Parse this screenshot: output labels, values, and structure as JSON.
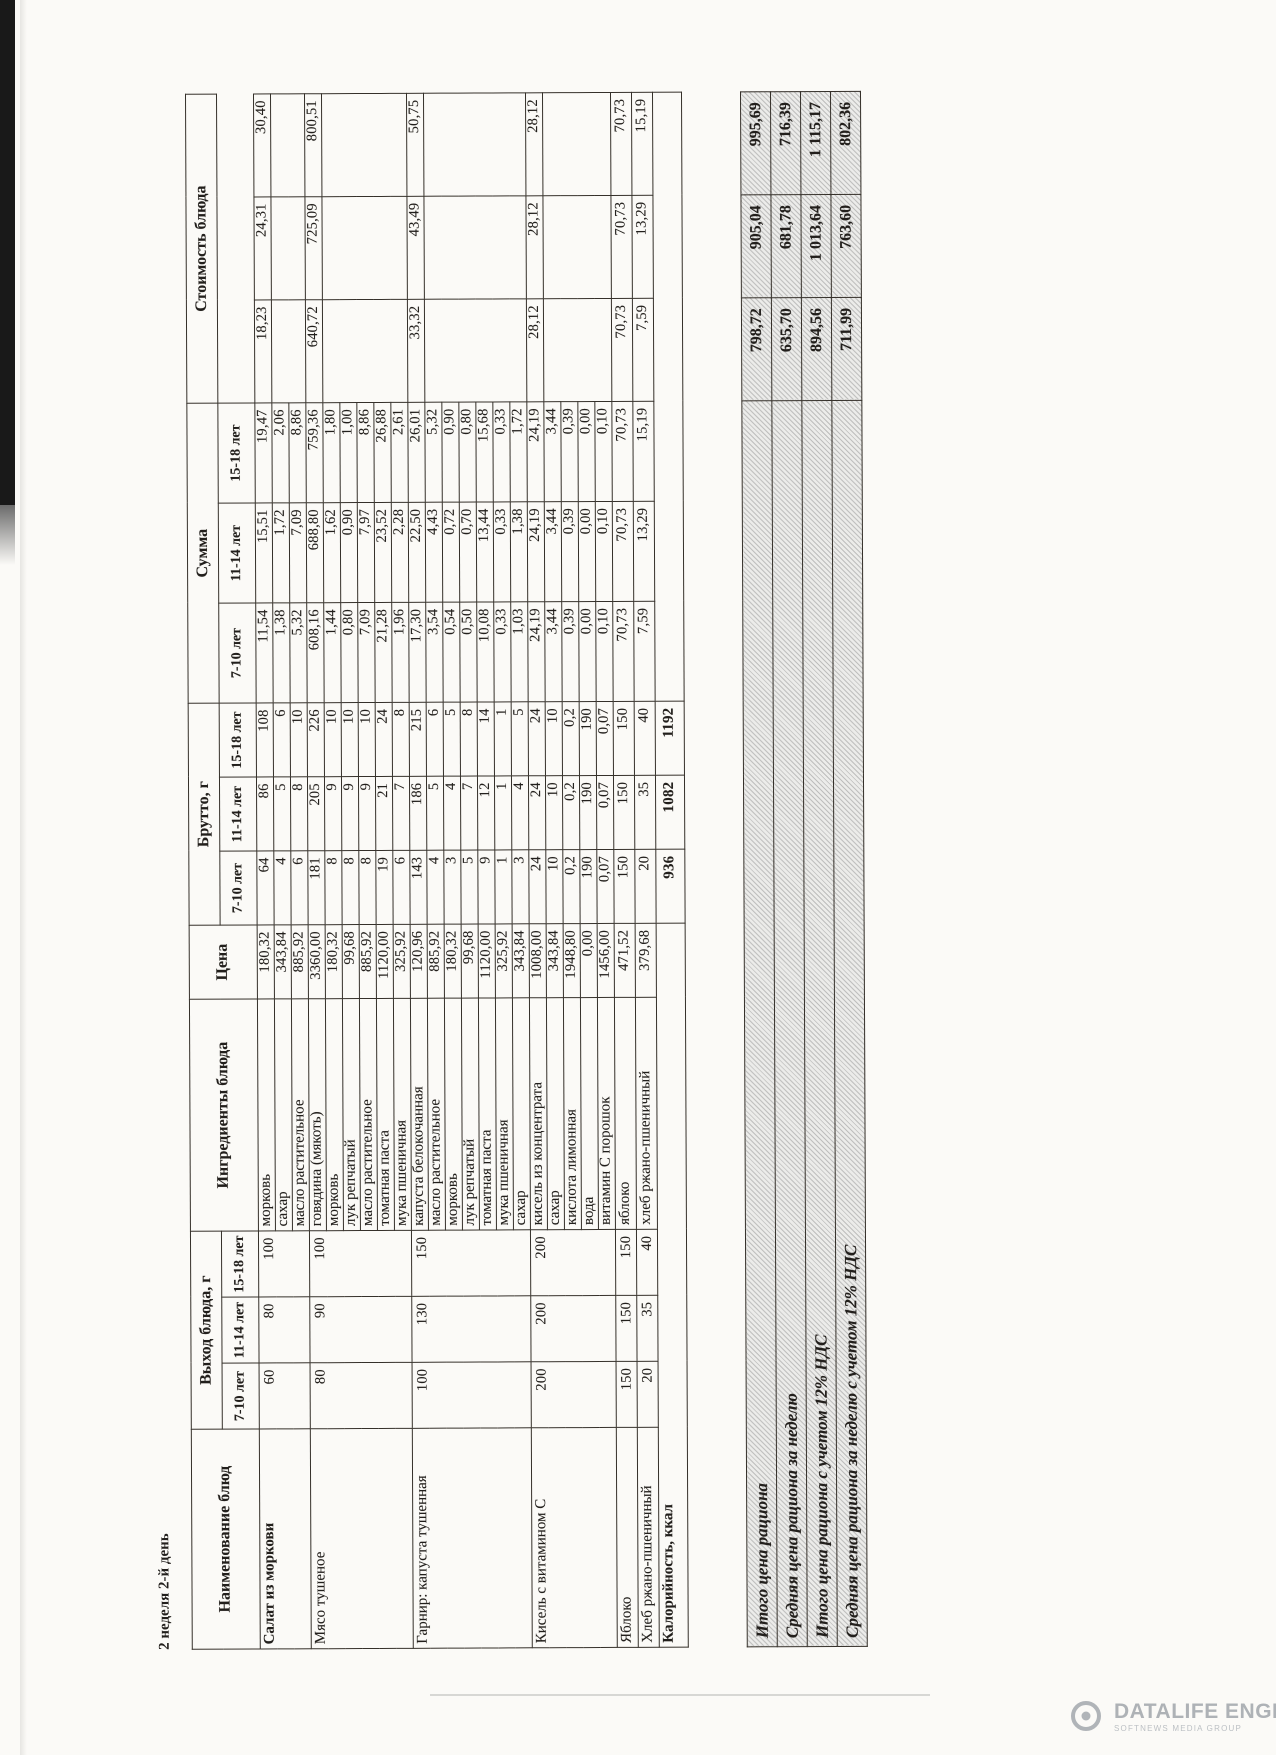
{
  "page": {
    "side_title": "2 неделя 2-й день"
  },
  "watermark": {
    "name": "DATALIFE ENGINE",
    "tagline": "SOFTNEWS MEDIA GROUP"
  },
  "menu_table": {
    "headers": {
      "dish": "Наименование блюд",
      "yield_group": "Выход блюда, г",
      "ingredients": "Ингредиенты блюда",
      "price": "Цена",
      "brutto_group": "Брутто, г",
      "sum_group": "Сумма",
      "cost_group": "Стоимость блюда",
      "ages": [
        "7-10 лет",
        "11-14 лет",
        "15-18 лет"
      ]
    },
    "dishes": [
      {
        "name": "Салат из моркови",
        "yield": [
          "60",
          "80",
          "100"
        ],
        "cost": [
          "18,23",
          "24,31",
          "30,40"
        ],
        "ingredients": [
          {
            "name": "морковь",
            "price": "180,32",
            "brutto": [
              "64",
              "86",
              "108"
            ],
            "sum": [
              "11,54",
              "15,51",
              "19,47"
            ]
          },
          {
            "name": "сахар",
            "price": "343,84",
            "brutto": [
              "4",
              "5",
              "6"
            ],
            "sum": [
              "1,38",
              "1,72",
              "2,06"
            ]
          },
          {
            "name": "масло растительное",
            "price": "885,92",
            "brutto": [
              "6",
              "8",
              "10"
            ],
            "sum": [
              "5,32",
              "7,09",
              "8,86"
            ]
          }
        ]
      },
      {
        "name": "Мясо тушеное",
        "yield": [
          "80",
          "90",
          "100"
        ],
        "cost": [
          "640,72",
          "725,09",
          "800,51"
        ],
        "ingredients": [
          {
            "name": "говядина (мякоть)",
            "price": "3360,00",
            "brutto": [
              "181",
              "205",
              "226"
            ],
            "sum": [
              "608,16",
              "688,80",
              "759,36"
            ]
          },
          {
            "name": "морковь",
            "price": "180,32",
            "brutto": [
              "8",
              "9",
              "10"
            ],
            "sum": [
              "1,44",
              "1,62",
              "1,80"
            ]
          },
          {
            "name": "лук репчатый",
            "price": "99,68",
            "brutto": [
              "8",
              "9",
              "10"
            ],
            "sum": [
              "0,80",
              "0,90",
              "1,00"
            ]
          },
          {
            "name": "масло растительное",
            "price": "885,92",
            "brutto": [
              "8",
              "9",
              "10"
            ],
            "sum": [
              "7,09",
              "7,97",
              "8,86"
            ]
          },
          {
            "name": "томатная паста",
            "price": "1120,00",
            "brutto": [
              "19",
              "21",
              "24"
            ],
            "sum": [
              "21,28",
              "23,52",
              "26,88"
            ]
          },
          {
            "name": "мука пшеничная",
            "price": "325,92",
            "brutto": [
              "6",
              "7",
              "8"
            ],
            "sum": [
              "1,96",
              "2,28",
              "2,61"
            ]
          }
        ]
      },
      {
        "name": "Гарнир: капуста тушенная",
        "yield": [
          "100",
          "130",
          "150"
        ],
        "cost": [
          "33,32",
          "43,49",
          "50,75"
        ],
        "ingredients": [
          {
            "name": "капуста белокочанная",
            "price": "120,96",
            "brutto": [
              "143",
              "186",
              "215"
            ],
            "sum": [
              "17,30",
              "22,50",
              "26,01"
            ]
          },
          {
            "name": "масло растительное",
            "price": "885,92",
            "brutto": [
              "4",
              "5",
              "6"
            ],
            "sum": [
              "3,54",
              "4,43",
              "5,32"
            ]
          },
          {
            "name": "морковь",
            "price": "180,32",
            "brutto": [
              "3",
              "4",
              "5"
            ],
            "sum": [
              "0,54",
              "0,72",
              "0,90"
            ]
          },
          {
            "name": "лук репчатый",
            "price": "99,68",
            "brutto": [
              "5",
              "7",
              "8"
            ],
            "sum": [
              "0,50",
              "0,70",
              "0,80"
            ]
          },
          {
            "name": "томатная паста",
            "price": "1120,00",
            "brutto": [
              "9",
              "12",
              "14"
            ],
            "sum": [
              "10,08",
              "13,44",
              "15,68"
            ]
          },
          {
            "name": "мука пшеничная",
            "price": "325,92",
            "brutto": [
              "1",
              "1",
              "1"
            ],
            "sum": [
              "0,33",
              "0,33",
              "0,33"
            ]
          },
          {
            "name": "сахар",
            "price": "343,84",
            "brutto": [
              "3",
              "4",
              "5"
            ],
            "sum": [
              "1,03",
              "1,38",
              "1,72"
            ]
          }
        ]
      },
      {
        "name": "Кисель с витамином С",
        "yield": [
          "200",
          "200",
          "200"
        ],
        "cost": [
          "28,12",
          "28,12",
          "28,12"
        ],
        "ingredients": [
          {
            "name": "кисель из концентрата",
            "price": "1008,00",
            "brutto": [
              "24",
              "24",
              "24"
            ],
            "sum": [
              "24,19",
              "24,19",
              "24,19"
            ]
          },
          {
            "name": "сахар",
            "price": "343,84",
            "brutto": [
              "10",
              "10",
              "10"
            ],
            "sum": [
              "3,44",
              "3,44",
              "3,44"
            ]
          },
          {
            "name": "кислота лимонная",
            "price": "1948,80",
            "brutto": [
              "0,2",
              "0,2",
              "0,2"
            ],
            "sum": [
              "0,39",
              "0,39",
              "0,39"
            ]
          },
          {
            "name": "вода",
            "price": "0,00",
            "brutto": [
              "190",
              "190",
              "190"
            ],
            "sum": [
              "0,00",
              "0,00",
              "0,00"
            ]
          },
          {
            "name": "витамин С порошок",
            "price": "1456,00",
            "brutto": [
              "0,07",
              "0,07",
              "0,07"
            ],
            "sum": [
              "0,10",
              "0,10",
              "0,10"
            ]
          }
        ]
      },
      {
        "name": "Яблоко",
        "yield": [
          "150",
          "150",
          "150"
        ],
        "cost": [
          "70,73",
          "70,73",
          "70,73"
        ],
        "ingredients": [
          {
            "name": "яблоко",
            "price": "471,52",
            "brutto": [
              "150",
              "150",
              "150"
            ],
            "sum": [
              "70,73",
              "70,73",
              "70,73"
            ]
          }
        ]
      },
      {
        "name": "Хлеб ржано-пшеничный",
        "yield": [
          "20",
          "35",
          "40"
        ],
        "cost": [
          "7,59",
          "13,29",
          "15,19"
        ],
        "ingredients": [
          {
            "name": "хлеб ржано-пшеничный",
            "price": "379,68",
            "brutto": [
              "20",
              "35",
              "40"
            ],
            "sum": [
              "7,59",
              "13,29",
              "15,19"
            ]
          }
        ]
      }
    ],
    "calories_row": {
      "label": "Калорийность, ккал",
      "values": [
        "936",
        "1082",
        "1192"
      ]
    },
    "summary": [
      {
        "label": "Итого цена рациона",
        "values": [
          "798,72",
          "905,04",
          "995,69"
        ]
      },
      {
        "label": "Средняя цена рациона за неделю",
        "values": [
          "635,70",
          "681,78",
          "716,39"
        ]
      },
      {
        "label": "Итого цена рациона с учетом 12% НДС",
        "values": [
          "894,56",
          "1 013,64",
          "1 115,17"
        ]
      },
      {
        "label": "Средняя цена рациона за неделю с учетом 12% НДС",
        "values": [
          "711,99",
          "763,60",
          "802,36"
        ]
      }
    ]
  }
}
